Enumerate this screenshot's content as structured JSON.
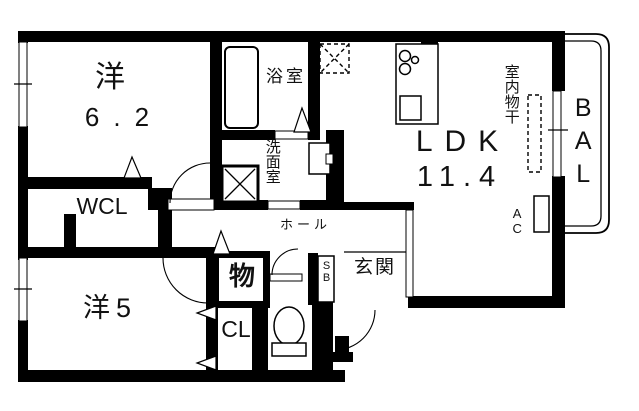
{
  "plan_title": "apartment-floorplan",
  "labels": {
    "bedroom1": {
      "name": "洋",
      "size": "6.2"
    },
    "bedroom2": {
      "name": "洋5"
    },
    "wcl": {
      "name": "WCL"
    },
    "bath": {
      "name": "浴室"
    },
    "washroom": {
      "name": "洗面室"
    },
    "hall": {
      "name": "ホール"
    },
    "storage": {
      "name": "物"
    },
    "closet": {
      "name": "CL"
    },
    "ldk": {
      "name": "LDK",
      "size": "11.4"
    },
    "drying": {
      "name": "室内物干"
    },
    "ac": {
      "name": "AC"
    },
    "balcony": {
      "name": "BAL"
    },
    "entrance": {
      "name": "玄関"
    },
    "shoebox": {
      "name": "SB"
    }
  },
  "colors": {
    "wall": "#000000",
    "floor": "#ffffff",
    "line": "#000000"
  }
}
